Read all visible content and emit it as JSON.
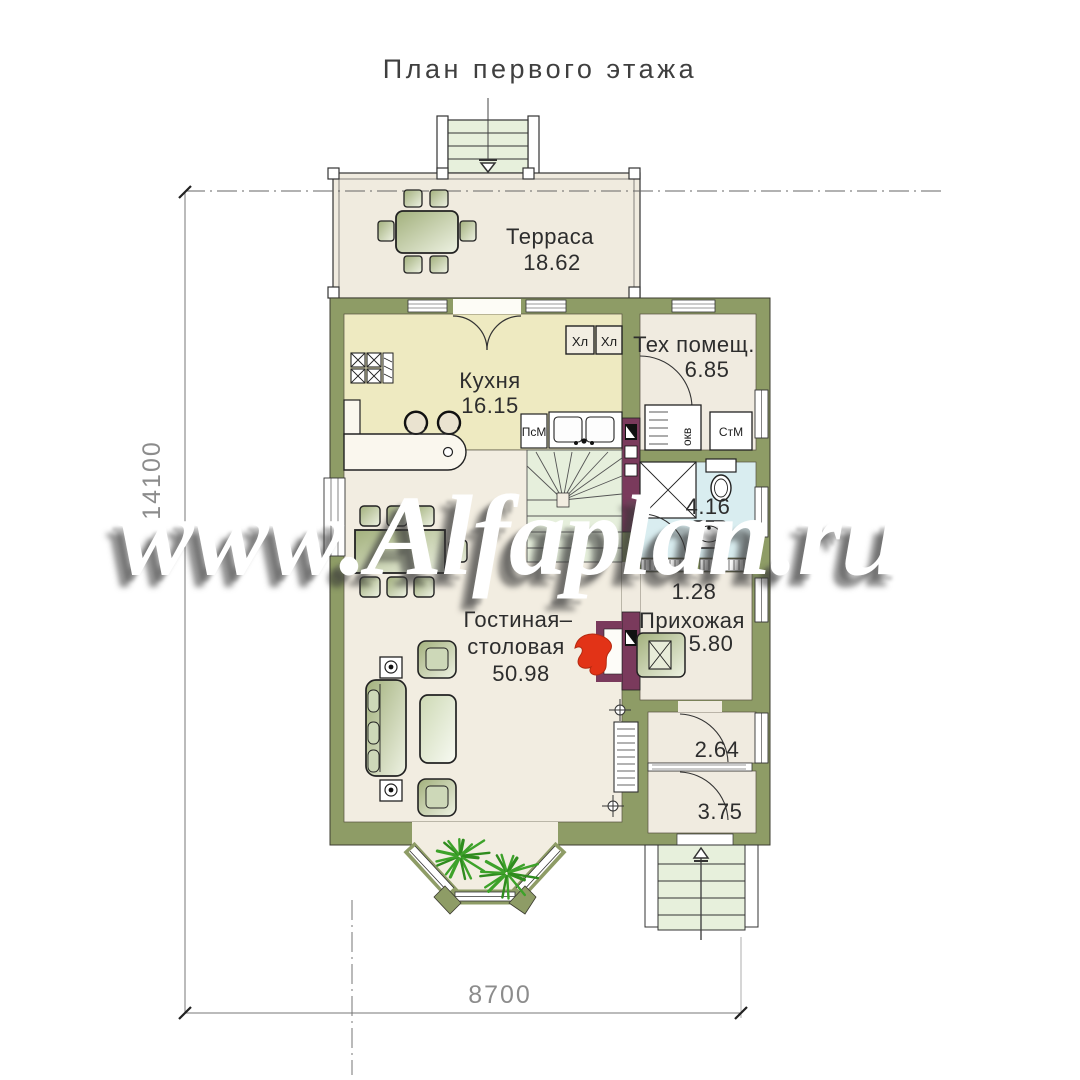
{
  "title": "План первого этажа",
  "watermark": "www.Alfaplan.ru",
  "rooms": {
    "terrace": {
      "label": "Терраса",
      "area": "18.62"
    },
    "kitchen": {
      "label": "Кухня",
      "area": "16.15"
    },
    "tech_room": {
      "label": "Тех помещ.",
      "area": "6.85"
    },
    "bathroom": {
      "area": "4.16"
    },
    "corridor": {
      "area": "1.28"
    },
    "hallway": {
      "label": "Прихожая",
      "area": "5.80"
    },
    "living_dining": {
      "label_line1": "Гостиная–",
      "label_line2": "столовая",
      "area": "50.98"
    },
    "vestibule": {
      "area": "2.64"
    },
    "entry": {
      "area": "3.75"
    }
  },
  "appliances": {
    "fridge_1": "Хл",
    "fridge_2": "Хл",
    "dishwasher": "ПсМ",
    "washing_machine": "СтМ",
    "boiler": "окв"
  },
  "dimensions": {
    "plan_width": "8700",
    "plan_height": "14100"
  },
  "colors": {
    "wall": "#8e9c66",
    "floor": "#f2ede1",
    "kitchen_floor": "#eeeac1",
    "bathroom_floor": "#d9edf0",
    "stairs": "#e6efdc",
    "accent_maroon": "#7a3a5c",
    "flame_red": "#e23317",
    "plant_green": "#3da22a"
  }
}
